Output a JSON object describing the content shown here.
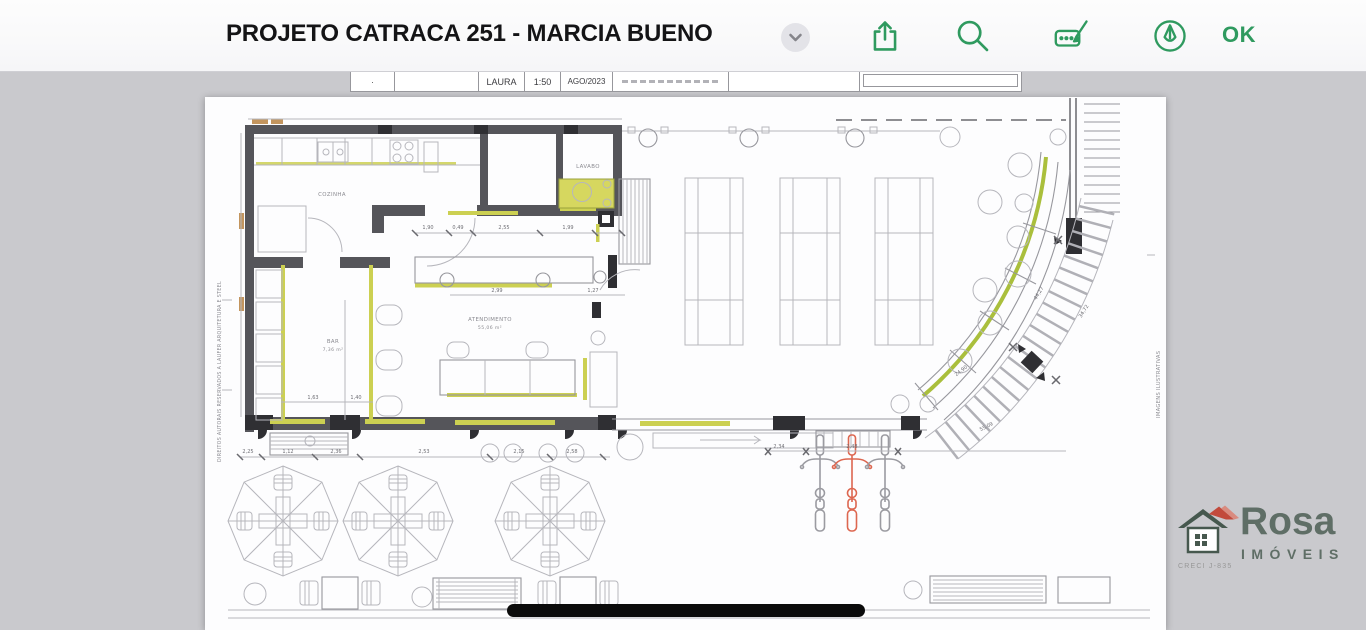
{
  "toolbar": {
    "title": "PROJETO CATRACA 251 - MARCIA BUENO",
    "ok_label": "OK",
    "accent_color": "#2f9a5f",
    "icons": [
      "chevron-down",
      "share",
      "search",
      "markup-box",
      "pen-circle"
    ]
  },
  "sheet_strip": {
    "author": "LAURA",
    "scale": "1:50",
    "date": "AGO/2023"
  },
  "plan": {
    "rooms": {
      "cozinha": "COZINHA",
      "lavabo": "LAVABO",
      "bar": "BAR",
      "bar_area": "7,36 m²",
      "atendimento": "ATENDIMENTO",
      "atendimento_area": "55,06 m²"
    },
    "notes": {
      "left": "DIREITOS AUTORAIS RESERVADOS A LAUFER ARQUITETURA E STEEL",
      "right": "IMAGENS ILUSTRATIVAS"
    },
    "dims_counter_top": [
      "1,90",
      "0,49",
      "2,55",
      "1,99"
    ],
    "dims_counter_bottom": [
      "2,99",
      "1,27"
    ],
    "dims_bar": [
      "1,63",
      "1,40"
    ],
    "dims_bottom": [
      "2,25",
      "1,12",
      "2,36",
      "2,53",
      "2,15",
      "2,58"
    ],
    "dims_bikes": [
      "2,34",
      "2,48"
    ],
    "dims_curve": [
      "44,27",
      "34,72",
      "24,90",
      "55,09"
    ],
    "highlight_color": "#b5c43d",
    "wall_color": "#55555a",
    "red_bike_color": "#dd6750"
  },
  "watermark": {
    "name": "Rosa",
    "subtitle": "IMÓVEIS",
    "creci": "CRECI J-835"
  }
}
